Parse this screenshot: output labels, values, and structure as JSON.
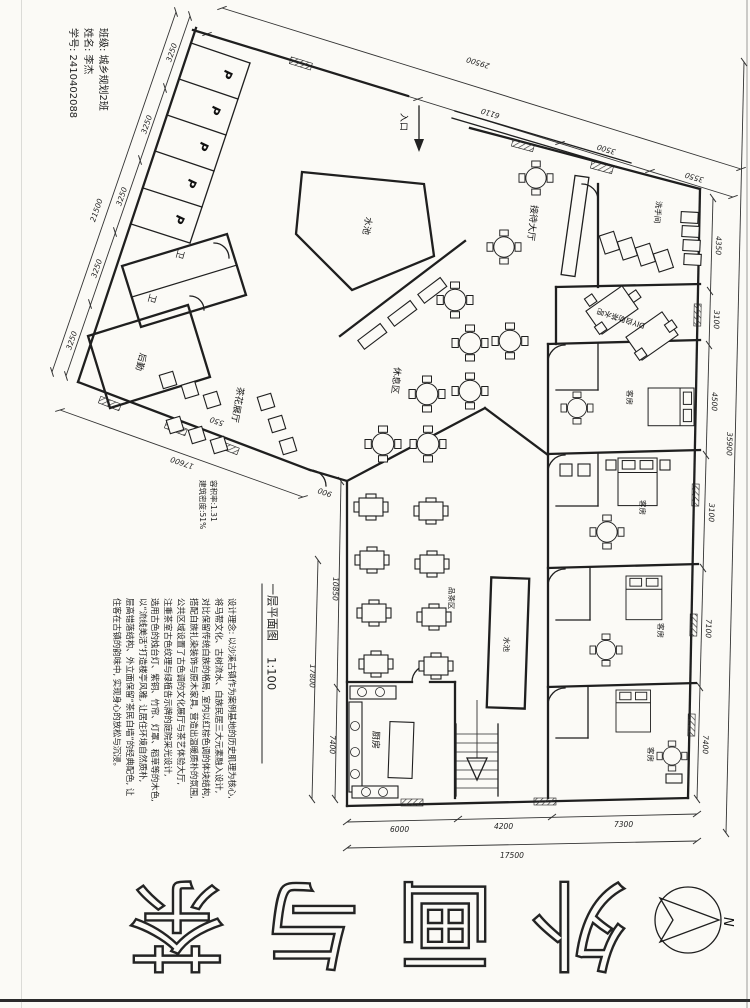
{
  "student_info": {
    "line1": "班级: 城乡规划2班",
    "line2": "姓名: 李杰",
    "line3": "学号: 2410402088"
  },
  "rooms": {
    "parking": "P",
    "wc": "卫",
    "logistics": "后勤",
    "exhibition": "茶花展厅",
    "pond": "水池",
    "reception": "接待大厅",
    "restroom": "洗手间",
    "tea_bar": "DIY自助茶水吧",
    "lounge": "休息区",
    "guest_room": "客房",
    "tea_seating": "品茶区",
    "kitchen": "厨房",
    "pond2": "水池",
    "entry": "入口"
  },
  "dimensions": {
    "top": {
      "total": "29500",
      "seg1": "6110",
      "seg2": "3500",
      "seg3": "3550"
    },
    "right": {
      "total": "35900",
      "seg1": "4350",
      "seg2": "3100",
      "seg3": "4500",
      "seg4": "3100",
      "seg5": "7100",
      "seg6": "7400"
    },
    "bottom": {
      "total": "17500",
      "seg1": "6000",
      "seg2": "4200",
      "seg3": "7300"
    },
    "left": {
      "total": "21500",
      "stall": "3250"
    },
    "left_wing": {
      "total": "17600",
      "small1": "550",
      "small2": "900"
    },
    "block_left": {
      "total": "17800",
      "seg1": "10850",
      "seg2": "7400"
    }
  },
  "area_note": {
    "line1": "容积率:1.31",
    "line2": "建筑密度:51%"
  },
  "plan_title": {
    "name": "一层平面图",
    "scale": "1:100"
  },
  "description": {
    "line1": "设计理念: 以沙溪古镇作为案例基地的历史肌理为核心,",
    "line2": "将马帮文化、古树流水、白族民居三大元素融入设计,",
    "line3": "对比保留传统白族的格局, 室内以红棕色调的体块结构,",
    "line4": "搭配白族扎染装饰与原木家具, 营造出温暖质朴的氛围,",
    "line5": "公共区域设置了古色调的文化展厅与茶艺体验大厅,",
    "line6": "注重茶室古色纹理与绿植告示牌的庭院采光设计,",
    "line7": "选用古色的烛台灯、紫铜、竹帘、灯罩、稻草等的木色,",
    "line8": "以“流线美活”打造楼亭风雅, 让居住环境自然质朴,",
    "line9": "层高错落结构、外立面保留“茶民白墙”的经典配色, 让",
    "line10": "住客在古镇的韵味中, 实现身心的放松与沉浸。"
  },
  "main_title": {
    "char1": "茶",
    "char2": "与",
    "char3": "画",
    "char4": "外"
  },
  "compass": {
    "north": "N"
  }
}
